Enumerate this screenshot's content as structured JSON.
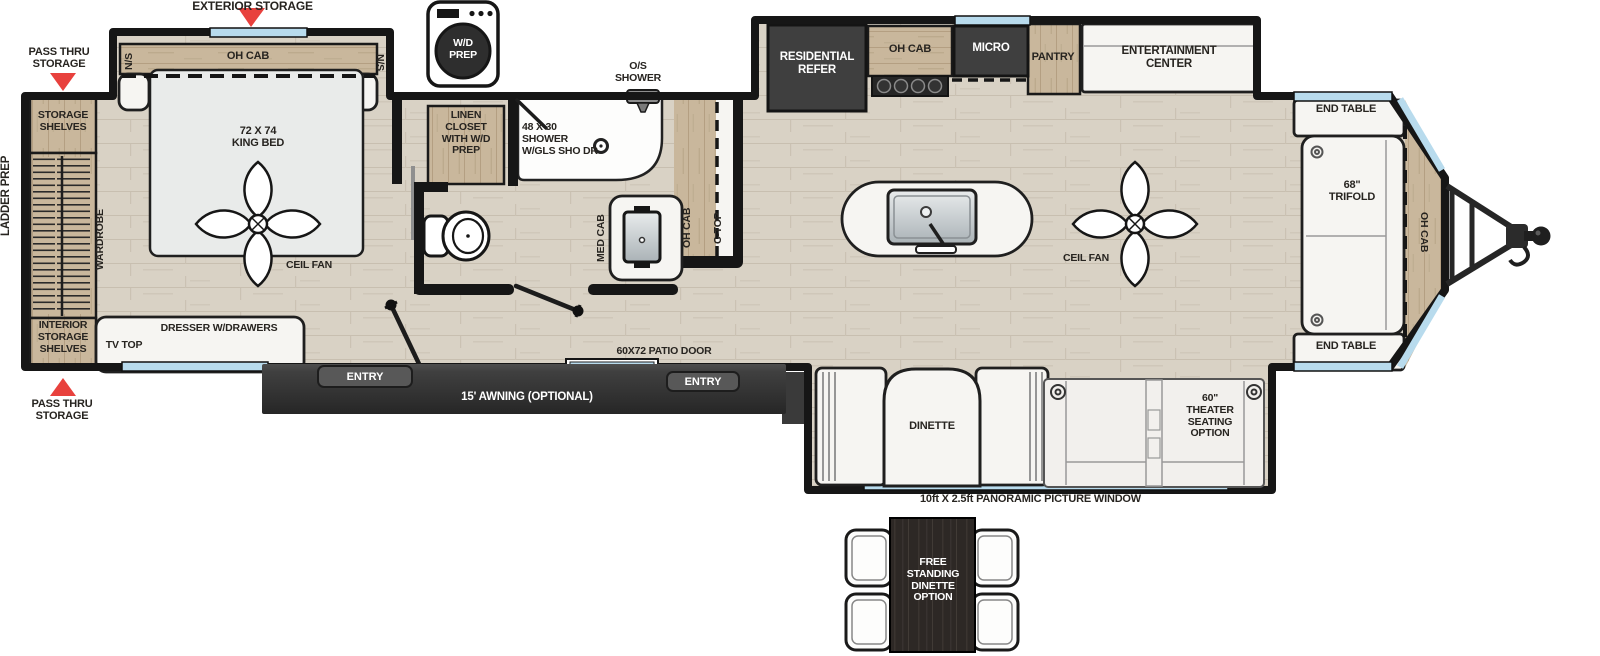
{
  "colors": {
    "wall": "#161616",
    "floor": "#d9d2c5",
    "cabinet_wood": "#c9b79c",
    "dark_appliance": "#3d3d3d",
    "window_blue": "#b8dbed",
    "accent_red": "#e8413d",
    "white_furniture": "#f6f5f2",
    "label_text": "#272420"
  },
  "floorplan": {
    "rear": {
      "ladder_prep": "LADDER PREP",
      "pass_thru_top": "PASS THRU\nSTORAGE",
      "pass_thru_bottom": "PASS THRU\nSTORAGE",
      "storage_shelves": "STORAGE\nSHELVES",
      "interior_storage_shelves": "INTERIOR\nSTORAGE\nSHELVES",
      "wardrobe": "WARDROBE",
      "tv_top": "TV TOP",
      "dresser": "DRESSER W/DRAWERS"
    },
    "bedroom": {
      "exterior_storage": "EXTERIOR STORAGE",
      "ns_left": "N/S",
      "ns_right": "N/S",
      "oh_cab": "OH CAB",
      "king_bed": "72 X 74\nKING BED",
      "ceil_fan": "CEIL FAN"
    },
    "bath": {
      "wd_prep": "W/D\nPREP",
      "linen_closet": "LINEN\nCLOSET\nWITH W/D\nPREP",
      "os_shower": "O/S\nSHOWER",
      "shower": "48 X 30\nSHOWER\nW/GLS SHO DR",
      "med_cab": "MED CAB"
    },
    "kitchen": {
      "oh_cab_strip": "OH CAB",
      "c_top": "C-TOP",
      "refer": "RESIDENTIAL\nREFER",
      "oh_cab": "OH CAB",
      "micro": "MICRO",
      "pantry": "PANTRY",
      "ceil_fan": "CEIL FAN"
    },
    "living": {
      "entertainment_center": "ENTERTAINMENT\nCENTER",
      "end_table_top": "END TABLE",
      "end_table_bottom": "END TABLE",
      "trifold": "68\"\nTRIFOLD",
      "oh_cab_front": "OH CAB"
    },
    "doors": {
      "patio_door": "60X72 PATIO DOOR",
      "entry_left": "ENTRY",
      "entry_right": "ENTRY",
      "awning": "15' AWNING (OPTIONAL)"
    },
    "options": {
      "dinette": "DINETTE",
      "theater": "60\"\nTHEATER\nSEATING\nOPTION",
      "pano_window": "10ft X 2.5ft PANORAMIC PICTURE WINDOW",
      "free_standing": "FREE\nSTANDING\nDINETTE\nOPTION"
    }
  }
}
